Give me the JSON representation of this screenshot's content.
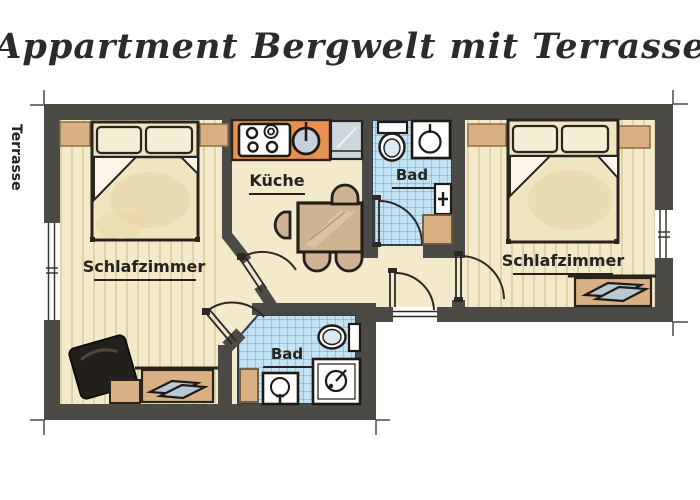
{
  "title": "Appartment Bergwelt mit Terrasse",
  "rooms": {
    "terrace": "Terrasse",
    "bedroom_left": "Schlafzimmer",
    "bedroom_right": "Schlafzimmer",
    "kitchen": "Küche",
    "bath_top": "Bad",
    "bath_bottom": "Bad"
  },
  "furniture_icons": [
    "double-bed",
    "pillow",
    "nightstand",
    "armchair",
    "stool",
    "bench",
    "luggage-rack",
    "dining-table",
    "chair",
    "stove",
    "kitchen-sink",
    "sideboard",
    "toilet",
    "washbasin",
    "shower",
    "shower-control",
    "bath-step",
    "window",
    "door-arc",
    "entrance-sill"
  ],
  "colors": {
    "wall": "#4b4a45",
    "floor": "#f3e9cb",
    "floor_stripe": "#ddcfa3",
    "tile": "#c3e2f3",
    "tile_line": "#68a3cf",
    "counter_orange": "#e8914e",
    "wood": "#cdb392",
    "wood_dark": "#d8b083",
    "outline": "#2a251f",
    "fixture_white": "#ffffff",
    "steel_blue": "#c7d1da",
    "text": "#262220",
    "chair_black": "#23201c"
  }
}
